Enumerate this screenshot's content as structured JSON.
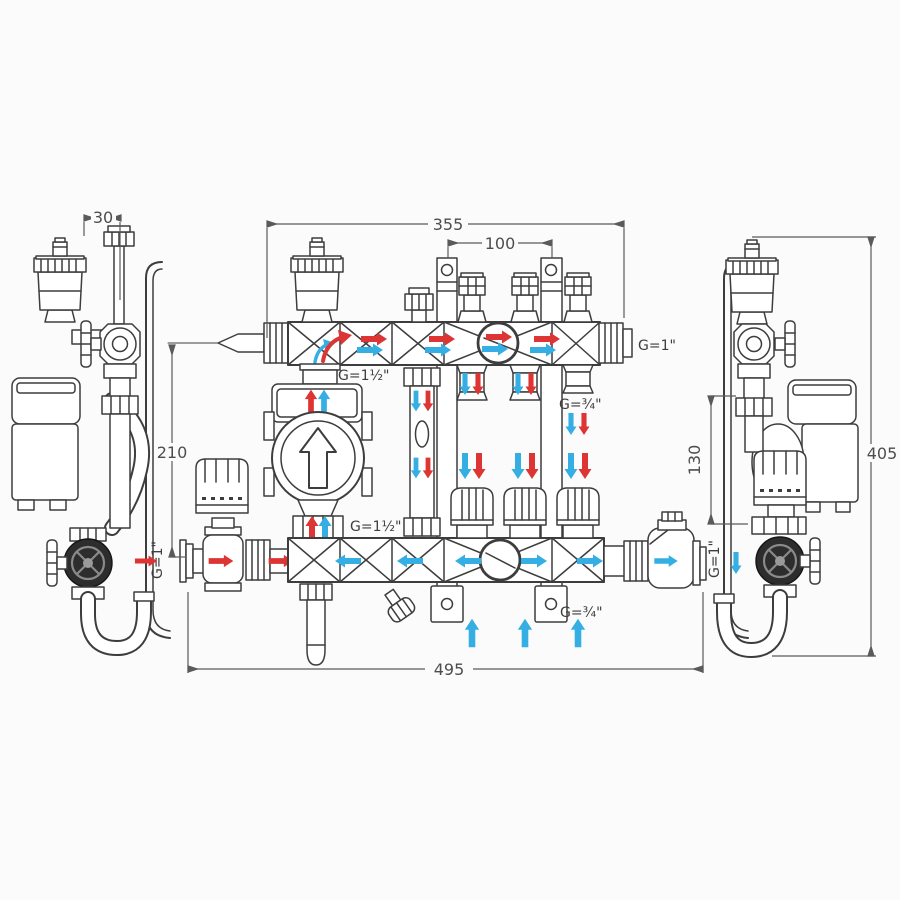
{
  "diagram": {
    "kind": "technical dimensional drawing",
    "subject": "underfloor-heating manifold mixing unit with pump, front view and two side views",
    "colors": {
      "background": "#fbfbfb",
      "line_art": "#3d3d3d",
      "dimension_lines": "#5a5a5a",
      "hot_flow_arrows": "#dd3434",
      "cold_flow_arrows": "#35afe3"
    },
    "labels": {
      "dim_30": "30",
      "dim_355": "355",
      "dim_100": "100",
      "dim_210": "210",
      "dim_130": "130",
      "dim_405": "405",
      "dim_495": "495",
      "g_supply_inlet": "G=1½\"",
      "g_manifold_end": "G=1\"",
      "g_loop_outlet_top": "G=¾\"",
      "g_pump_union": "G=1½\"",
      "g_loop_outlet_bottom": "G=¾\"",
      "g_left_port": "G=1\"",
      "g_right_port": "G=1\""
    }
  }
}
